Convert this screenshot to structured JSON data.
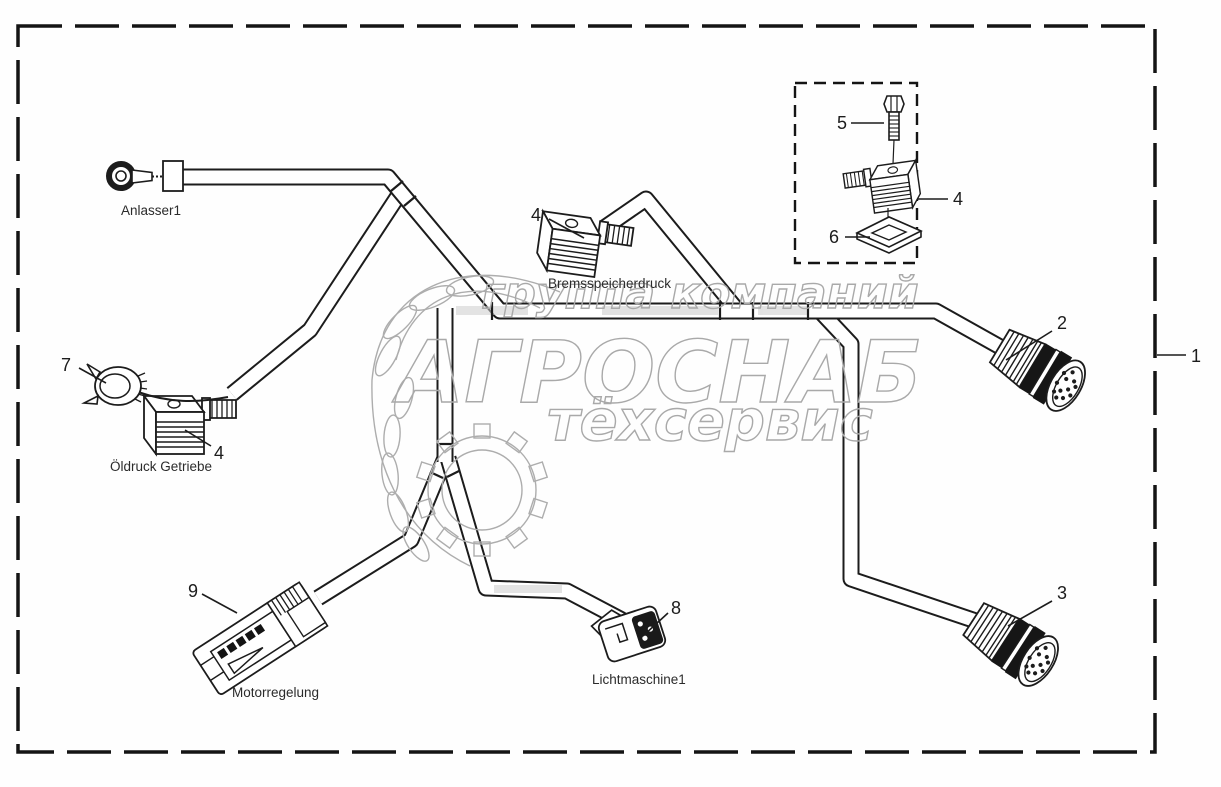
{
  "page": {
    "background": "#fefefe",
    "line_color": "#1c1c1c",
    "watermark_color": "#a9a9a9"
  },
  "watermark": {
    "line1": "группа компаний",
    "line2": "АГРОСНАБ",
    "line3": "тёхсервис"
  },
  "part_labels": {
    "anlasser": "Anlasser1",
    "bremsspeicherdruck": "Bremsspeicherdruck",
    "oeldruck_getriebe": "Öldruck Getriebe",
    "motorregelung": "Motorregelung",
    "lichtmaschine": "Lichtmaschine1"
  },
  "callouts": {
    "harness": "1",
    "round_connector_upper": "2",
    "round_connector_lower": "3",
    "valve_connector": "4",
    "screw": "5",
    "seal": "6",
    "cap": "7",
    "alternator_connector": "8",
    "ecu_connector": "9"
  }
}
